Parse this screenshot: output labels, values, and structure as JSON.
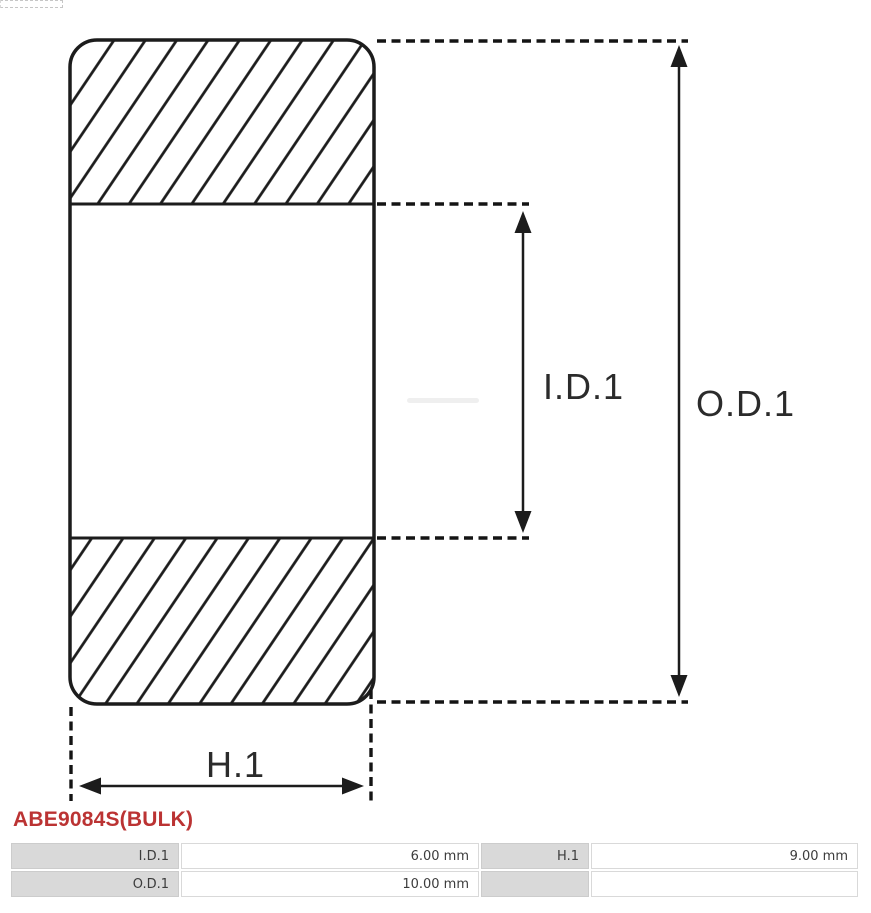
{
  "part_header": {
    "title": "ABE9084S(BULK)",
    "accent_color": "#bb3333"
  },
  "diagram": {
    "type": "bearing-cross-section",
    "line_color": "#1c1c1c",
    "labels": {
      "inner_diameter": "I.D.1",
      "outer_diameter": "O.D.1",
      "height": "H.1"
    }
  },
  "dimensions_table": {
    "rows": [
      {
        "cells": [
          {
            "label": "I.D.1",
            "value": "6.00 mm"
          },
          {
            "label": "H.1",
            "value": "9.00 mm"
          }
        ]
      },
      {
        "cells": [
          {
            "label": "O.D.1",
            "value": "10.00 mm"
          },
          {
            "label": "",
            "value": ""
          }
        ]
      }
    ]
  }
}
